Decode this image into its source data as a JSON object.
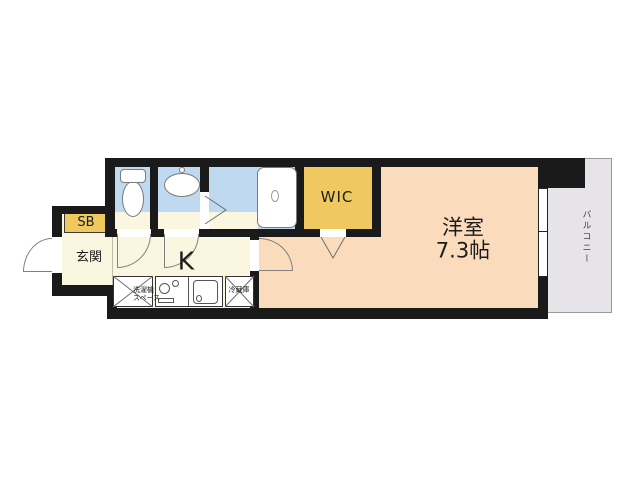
{
  "colors": {
    "wall": "#1a1a1a",
    "wet_area_blue": "#bfd9f0",
    "hall_cream": "#faf6df",
    "room_peach": "#fadcbd",
    "accent_yellow": "#efc95f",
    "balcony_gray": "#e6e4e8",
    "line_gray": "#808080"
  },
  "rooms": {
    "entrance": {
      "label": "玄関"
    },
    "shoe_box": {
      "label": "SB"
    },
    "kitchen": {
      "label": "K"
    },
    "wic": {
      "label": "WIC"
    },
    "western_room": {
      "name": "洋室",
      "size": "7.3帖"
    },
    "balcony": {
      "label": "バルコニー"
    }
  },
  "fixtures": {
    "washer_space": {
      "line1": "洗濯機",
      "line2": "スペース"
    },
    "refrigerator": {
      "label": "冷蔵庫"
    }
  }
}
